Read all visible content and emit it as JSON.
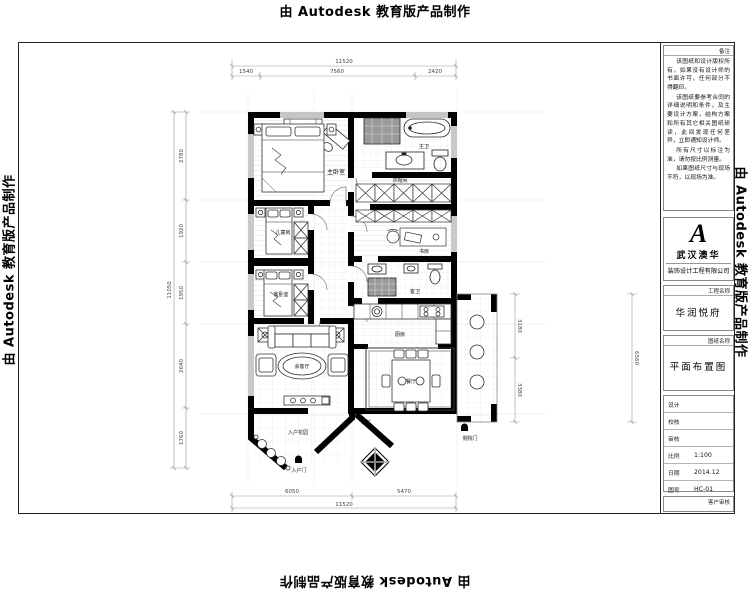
{
  "watermark": {
    "text": "由 Autodesk 教育版产品制作"
  },
  "title_block": {
    "notes_label": "备注",
    "notes": [
      "该图纸和设计版权所有，如果没有设计师的书面许可，任何部分不得翻印。",
      "该图纸要参考合同的详细说明和条件，及主要设计方案，结构方案和所有其它相关图纸研读，此间发现任何差异，立即通知设计师。",
      "所有尺寸以标注为准，请勿按比例测量。",
      "如果图纸尺寸与现场不符，以现场为准。"
    ],
    "logo_glyph": "A",
    "company_name": "武汉澳华",
    "company_sub": "装饰设计工程有限公司",
    "project_label": "工程名称",
    "project_name": "华润悦府",
    "drawing_label": "图纸名称",
    "drawing_name": "平面布置图",
    "fields": [
      {
        "label": "设计",
        "value": ""
      },
      {
        "label": "校核",
        "value": ""
      },
      {
        "label": "审核",
        "value": ""
      },
      {
        "label": "比例",
        "value": "1:100"
      },
      {
        "label": "日期",
        "value": "2014.12"
      },
      {
        "label": "图号",
        "value": "HC-01"
      }
    ],
    "client_label": "客户审核"
  },
  "rooms": {
    "master_bedroom": "主卧室",
    "master_bath": "主卫",
    "cloakroom": "衣帽间",
    "kids_room": "儿童房",
    "guest_bedroom": "客卧室",
    "study": "书房",
    "guest_bath": "客卫",
    "kitchen": "厨房",
    "dining": "餐厅",
    "living": "会客厅",
    "entry_garden": "入户花园",
    "entry_door": "入户门",
    "foyer": "玄关",
    "side_door": "侧院门"
  },
  "dimensions": {
    "top_overall": "11520",
    "top_segments": [
      "1540",
      "7560",
      "2420"
    ],
    "left_overall": "11050",
    "left_segments": [
      "2780",
      "1920",
      "1950",
      "2640",
      "1760"
    ],
    "right_overall": "6560",
    "right_segments": [
      "3180",
      "3380"
    ],
    "bottom_overall": "11520",
    "bottom_segments": [
      "6050",
      "5470"
    ]
  }
}
